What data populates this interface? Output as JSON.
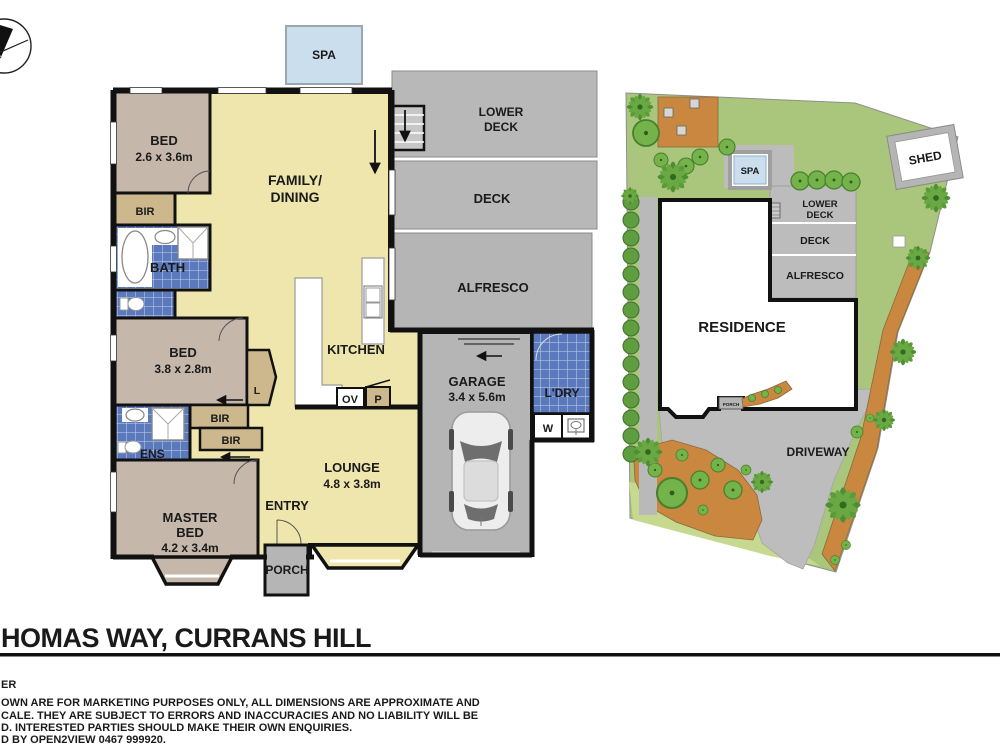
{
  "footer": {
    "title": "HOMAS WAY, CURRANS HILL",
    "d0": "ER",
    "d1": "OWN ARE FOR MARKETING PURPOSES ONLY, ALL DIMENSIONS ARE APPROXIMATE AND",
    "d2": "CALE. THEY ARE SUBJECT TO ERRORS AND INACCURACIES AND NO LIABILITY WILL BE",
    "d3": "D. INTERESTED PARTIES SHOULD MAKE THEIR OWN ENQUIRIES.",
    "d4": "D BY OPEN2VIEW 0467 999920."
  },
  "fp": {
    "spa": "SPA",
    "bed1": "BED",
    "bed1d": "2.6 x 3.6m",
    "bir1": "BIR",
    "bath": "BATH",
    "bed2": "BED",
    "bed2d": "3.8 x 2.8m",
    "linen": "L",
    "bir2": "BIR",
    "bir3": "BIR",
    "ens": "ENS",
    "master1": "MASTER",
    "master2": "BED",
    "masterd": "4.2 x 3.4m",
    "entry": "ENTRY",
    "porch": "PORCH",
    "lounge": "LOUNGE",
    "lounged": "4.8 x 3.8m",
    "family1": "FAMILY/",
    "family2": "DINING",
    "kitchen": "KITCHEN",
    "ov": "OV",
    "p": "P",
    "garage": "GARAGE",
    "garaged": "3.4 x 5.6m",
    "ldry": "L'DRY",
    "w": "W",
    "lower1": "LOWER",
    "lower2": "DECK",
    "deck": "DECK",
    "alfresco": "ALFRESCO"
  },
  "sp": {
    "spa": "SPA",
    "lower1": "LOWER",
    "lower2": "DECK",
    "deck": "DECK",
    "alfresco": "ALFRESCO",
    "residence": "RESIDENCE",
    "porch": "PORCH",
    "driveway": "DRIVEWAY",
    "shed": "SHED"
  },
  "colors": {
    "room_yellow": "#efe6ad",
    "bedroom_tan": "#c5b8aa",
    "robe_tan": "#cdb88e",
    "tile_blue": "#5b79bd",
    "paving_gray": "#b5b5b5",
    "spa_blue": "#cadeed",
    "lawn_green": "#a9c67c",
    "lawn_light": "#c6d98f",
    "mulch_orange": "#c9873f",
    "tree_green": "#74b34a",
    "wall_black": "#111111"
  }
}
